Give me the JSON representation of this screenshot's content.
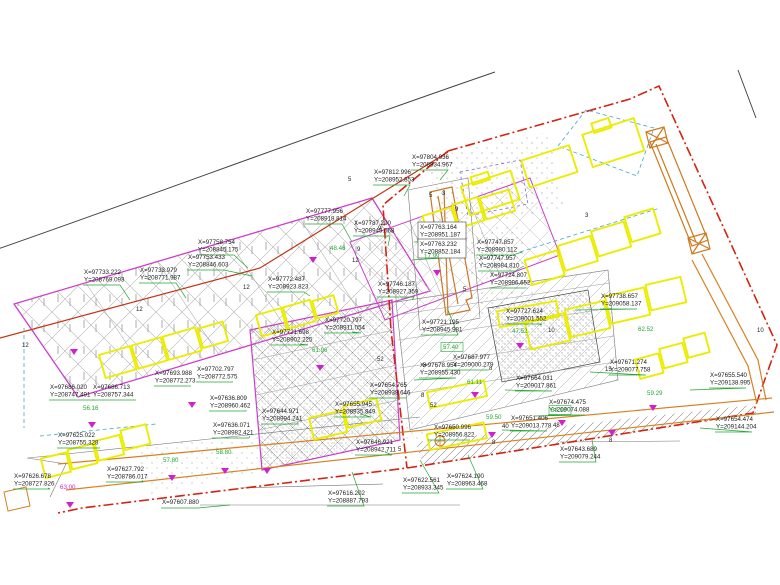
{
  "drawing": {
    "type": "cadastral-site-plan",
    "background": "#ffffff"
  },
  "colors": {
    "parcel_magenta": "#cc3ecc",
    "building_yellow": "#ecec00",
    "boundary_red": "#d42310",
    "road_orange": "#d7811f",
    "leader_green": "#22a833",
    "road_black": "#444444",
    "hatch_gray": "#9a9a9a",
    "cyan_dash": "#3fa8c8",
    "violet_dash": "#7a6ad8",
    "marker_magenta": "#d020d0",
    "text_black": "#1c1c1c"
  },
  "coordinate_labels": [
    {
      "x": "X=97733.222",
      "y": "Y=208769.093",
      "px": 84,
      "py": 268,
      "tx": 130,
      "ty": 300
    },
    {
      "x": "X=97733.979",
      "y": "Y=208771.987",
      "px": 140,
      "py": 266,
      "tx": 186,
      "ty": 298
    },
    {
      "x": "X=97758.754",
      "y": "Y=208845.175",
      "px": 198,
      "py": 238,
      "tx": 248,
      "ty": 268
    },
    {
      "x": "X=97753.433",
      "y": "Y=208846.603",
      "px": 188,
      "py": 253,
      "tx": 252,
      "ty": 276
    },
    {
      "x": "X=97777.956",
      "y": "Y=208918.814",
      "px": 306,
      "py": 207,
      "tx": 352,
      "ty": 242
    },
    {
      "x": "X=97772.487",
      "y": "Y=208923.823",
      "px": 268,
      "py": 275,
      "tx": 310,
      "ty": 296
    },
    {
      "x": "X=97787.290",
      "y": "Y=208949.068",
      "px": 354,
      "py": 219,
      "tx": 388,
      "ty": 246
    },
    {
      "x": "X=97812.996",
      "y": "Y=208952.853",
      "px": 374,
      "py": 168,
      "tx": 404,
      "ty": 196
    },
    {
      "x": "X=97804.936",
      "y": "Y=208934.967",
      "px": 412,
      "py": 153,
      "tx": 440,
      "ty": 180
    },
    {
      "x": "X=97763.164",
      "y": "Y=208951.187",
      "px": 420,
      "py": 223,
      "tx": 414,
      "ty": 242,
      "boxed": true
    },
    {
      "x": "X=97763.232",
      "y": "Y=208852.184",
      "px": 420,
      "py": 240,
      "tx": 412,
      "ty": 260,
      "boxed": true
    },
    {
      "x": "X=97747.857",
      "y": "Y=208980.112",
      "px": 477,
      "py": 238,
      "tx": 522,
      "ty": 252
    },
    {
      "x": "X=97747.957",
      "y": "Y=208984.810",
      "px": 479,
      "py": 254,
      "tx": 524,
      "ty": 266
    },
    {
      "x": "X=97724.807",
      "y": "Y=208996.652",
      "px": 490,
      "py": 271,
      "tx": 520,
      "ty": 288
    },
    {
      "x": "X=97746.187",
      "y": "Y=208927.359",
      "px": 378,
      "py": 280,
      "tx": 412,
      "ty": 300
    },
    {
      "x": "X=97721.195",
      "y": "Y=208945.981",
      "px": 422,
      "py": 318,
      "tx": 448,
      "ty": 310
    },
    {
      "x": "X=97727.624",
      "y": "Y=209001.552",
      "px": 506,
      "py": 307,
      "tx": 540,
      "ty": 325
    },
    {
      "x": "X=97738.657",
      "y": "Y=209058.137",
      "px": 601,
      "py": 292,
      "tx": 575,
      "ty": 310
    },
    {
      "x": "X=97671.274",
      "y": "Y=209077.758",
      "px": 610,
      "py": 358,
      "tx": 590,
      "ty": 372
    },
    {
      "x": "X=97655.540",
      "y": "Y=209138.995",
      "px": 710,
      "py": 371,
      "tx": 690,
      "ty": 390
    },
    {
      "x": "X=97654.474",
      "y": "Y=209144.204",
      "px": 716,
      "py": 415,
      "tx": 700,
      "ty": 428
    },
    {
      "x": "X=97674.475",
      "y": "Y=209074.088",
      "px": 549,
      "py": 398,
      "tx": 535,
      "ty": 416
    },
    {
      "x": "X=97664.031",
      "y": "Y=209017.861",
      "px": 516,
      "py": 374,
      "tx": 505,
      "ty": 390
    },
    {
      "x": "X=97687.977",
      "y": "Y=209000.279",
      "px": 453,
      "py": 353,
      "tx": 445,
      "ty": 370
    },
    {
      "x": "X=97678.954",
      "y": "Y=208955.430",
      "px": 420,
      "py": 361,
      "tx": 414,
      "ty": 380
    },
    {
      "x": "X=97651.406",
      "y": "Y=209013.778",
      "px": 511,
      "py": 414,
      "tx": 502,
      "ty": 430
    },
    {
      "x": "X=97650.996",
      "y": "Y=208956.822",
      "px": 434,
      "py": 423,
      "tx": 428,
      "ty": 440
    },
    {
      "x": "X=97643.689",
      "y": "Y=209079.244",
      "px": 560,
      "py": 445,
      "tx": 592,
      "ty": 440
    },
    {
      "x": "X=97624.190",
      "y": "Y=208963.468",
      "px": 447,
      "py": 472,
      "tx": 468,
      "ty": 455
    },
    {
      "x": "X=97622.561",
      "y": "Y=208933.345",
      "px": 403,
      "py": 476,
      "tx": 420,
      "ty": 460
    },
    {
      "x": "X=97616.202",
      "y": "Y=208887.793",
      "px": 328,
      "py": 489,
      "tx": 352,
      "ty": 472
    },
    {
      "x": "X=97607.880",
      "y": "",
      "px": 162,
      "py": 498,
      "tx": 230,
      "ty": 505
    },
    {
      "x": "X=97626.678",
      "y": "Y=208727.826",
      "px": 14,
      "py": 472,
      "tx": 48,
      "ty": 488
    },
    {
      "x": "X=97625.022",
      "y": "Y=208755.328",
      "px": 58,
      "py": 431,
      "tx": 100,
      "ty": 448
    },
    {
      "x": "X=97686.020",
      "y": "Y=208747.491",
      "px": 50,
      "py": 383,
      "tx": 94,
      "ty": 400
    },
    {
      "x": "X=97686.713",
      "y": "Y=208757.344",
      "px": 93,
      "py": 383,
      "tx": 136,
      "ty": 400
    },
    {
      "x": "X=97693.988",
      "y": "Y=208772.273",
      "px": 155,
      "py": 369,
      "tx": 186,
      "ty": 386
    },
    {
      "x": "X=97702.797",
      "y": "Y=208772.575",
      "px": 197,
      "py": 365,
      "tx": 226,
      "ty": 382
    },
    {
      "x": "X=97636.809",
      "y": "Y=208960.462",
      "px": 210,
      "py": 394,
      "tx": 246,
      "ty": 410
    },
    {
      "x": "X=97636.071",
      "y": "Y=208982.421",
      "px": 213,
      "py": 421,
      "tx": 250,
      "ty": 436
    },
    {
      "x": "X=97644.971",
      "y": "Y=208994.241",
      "px": 262,
      "py": 407,
      "tx": 298,
      "ty": 422
    },
    {
      "x": "X=97627.792",
      "y": "Y=208786.017",
      "px": 107,
      "py": 465,
      "tx": 142,
      "ty": 480
    },
    {
      "x": "X=97646.921",
      "y": "Y=208942.711",
      "px": 356,
      "py": 438,
      "tx": 385,
      "ty": 452
    },
    {
      "x": "X=97654.765",
      "y": "Y=208938.646",
      "px": 370,
      "py": 381,
      "tx": 396,
      "ty": 398
    },
    {
      "x": "X=97655.945",
      "y": "Y=208935.849",
      "px": 335,
      "py": 400,
      "tx": 360,
      "ty": 414
    },
    {
      "x": "X=97721.698",
      "y": "Y=208902.225",
      "px": 272,
      "py": 328,
      "tx": 300,
      "ty": 344
    },
    {
      "x": "X=97720.797",
      "y": "Y=208911.054",
      "px": 325,
      "py": 316,
      "tx": 352,
      "ty": 332
    }
  ],
  "elevation_labels": [
    {
      "v": "61.96",
      "px": 312,
      "py": 352
    },
    {
      "v": "57.40",
      "px": 443,
      "py": 349,
      "boxed": true
    },
    {
      "v": "59.50",
      "px": 486,
      "py": 419
    },
    {
      "v": "58.10",
      "px": 551,
      "py": 412,
      "boxed": true
    },
    {
      "v": "62.52",
      "px": 638,
      "py": 331
    },
    {
      "v": "61.11",
      "px": 467,
      "py": 384
    },
    {
      "v": "56.16",
      "px": 83,
      "py": 410
    },
    {
      "v": "63.00",
      "px": 60,
      "py": 489,
      "magenta": true
    },
    {
      "v": "57.80",
      "px": 163,
      "py": 462
    },
    {
      "v": "58.80",
      "px": 216,
      "py": 454
    },
    {
      "v": "48.46",
      "px": 330,
      "py": 250
    },
    {
      "v": "17.99",
      "px": 424,
      "py": 258
    },
    {
      "v": "47.52",
      "px": 512,
      "py": 333
    },
    {
      "v": "59.29",
      "px": 647,
      "py": 395
    }
  ],
  "dimension_labels": [
    {
      "v": "12",
      "px": 22,
      "py": 347
    },
    {
      "v": "12",
      "px": 136,
      "py": 311
    },
    {
      "v": "12",
      "px": 243,
      "py": 289
    },
    {
      "v": "12",
      "px": 352,
      "py": 262
    },
    {
      "v": "9",
      "px": 378,
      "py": 230
    },
    {
      "v": "9",
      "px": 455,
      "py": 211
    },
    {
      "v": "9",
      "px": 357,
      "py": 251
    },
    {
      "v": "5",
      "px": 348,
      "py": 181
    },
    {
      "v": "5",
      "px": 429,
      "py": 197
    },
    {
      "v": "5",
      "px": 463,
      "py": 291
    },
    {
      "v": "5",
      "px": 398,
      "py": 451
    },
    {
      "v": "8",
      "px": 421,
      "py": 397
    },
    {
      "v": "8",
      "px": 423,
      "py": 367
    },
    {
      "v": "8",
      "px": 489,
      "py": 370
    },
    {
      "v": "8",
      "px": 492,
      "py": 444
    },
    {
      "v": "8",
      "px": 609,
      "py": 442
    },
    {
      "v": "3",
      "px": 442,
      "py": 195
    },
    {
      "v": "3",
      "px": 585,
      "py": 217
    },
    {
      "v": "10",
      "px": 548,
      "py": 332
    },
    {
      "v": "10",
      "px": 757,
      "py": 332
    },
    {
      "v": "15",
      "px": 605,
      "py": 371
    },
    {
      "v": "48",
      "px": 553,
      "py": 427
    },
    {
      "v": "52",
      "px": 377,
      "py": 361
    },
    {
      "v": "40",
      "px": 502,
      "py": 428
    },
    {
      "v": "52",
      "px": 430,
      "py": 407
    }
  ],
  "survey_markers": [
    [
      74,
      349
    ],
    [
      313,
      257
    ],
    [
      437,
      270
    ],
    [
      320,
      365
    ],
    [
      520,
      343
    ],
    [
      475,
      392
    ],
    [
      492,
      432
    ],
    [
      612,
      430
    ],
    [
      92,
      422
    ],
    [
      192,
      402
    ],
    [
      172,
      475
    ],
    [
      225,
      468
    ],
    [
      267,
      468
    ],
    [
      70,
      502
    ],
    [
      562,
      420
    ],
    [
      653,
      405
    ]
  ]
}
